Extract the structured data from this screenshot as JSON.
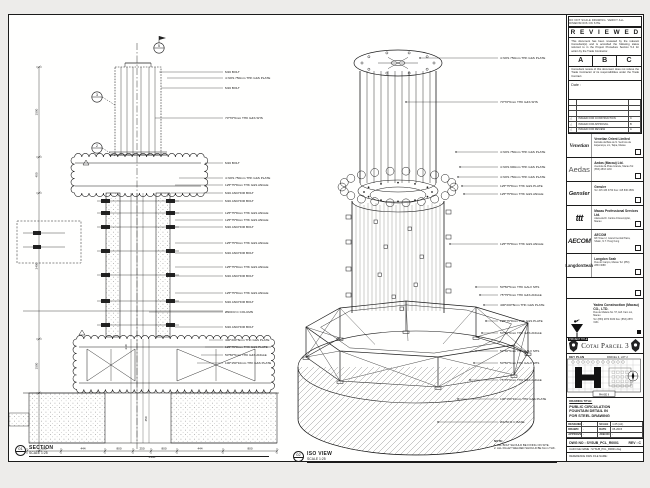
{
  "page": {
    "bg": "#edecea",
    "line": "#1b1b1b"
  },
  "section_view": {
    "marker_id": "01",
    "title": "SECTION",
    "scale": "SCALE 1:25",
    "bubbles": [
      "5",
      "3",
      "2"
    ],
    "labels": [
      "M16 BOLT",
      "4 NOS 750mm THK G&S PLATE",
      "M16 BOLT",
      "70*70*6mm THK G&S SHS",
      "M16 BOLT",
      "4 NOS 750mm THK G&S PLATE",
      "125*75*8mm THK G&S ANGLE",
      "M16 ANCHOR BOLT",
      "M16 ANCHOR BOLT",
      "125*75*8mm THK G&S ANGLE",
      "125*75*8mm THK G&S ANGLE",
      "M16 ANCHOR BOLT",
      "125*75*8mm THK G&S ANGLE",
      "M16 ANCHOR BOLT",
      "125*75*8mm THK G&S ANGLE",
      "M16 ANCHOR BOLT",
      "125*75*8mm THK G&S ANGLE",
      "M16 ANCHOR BOLT",
      "Ø900 R.C COLUMN",
      "M16 ANCHOR BOLT",
      "400*200*8mm THK G&S PLATE",
      "125*75*8mm THK G&S PLATE",
      "50*50*5mm THK G&S ANGLE",
      "100*150*10mm THK G&S PLATE"
    ],
    "dims_bottom": [
      "800",
      "444",
      "800",
      "250",
      "800",
      "444",
      "800"
    ],
    "dims_bottom_total": "4338",
    "dims_left": [
      "1500",
      "400",
      "2400",
      "1500"
    ],
    "dims_mid": [
      "450",
      "240"
    ]
  },
  "iso_view": {
    "marker_id": "02",
    "title": "ISO VIEW",
    "scale": "SCALE 1:25",
    "labels": [
      "4 NOS 750mm THK G&S PLATE",
      "70*70*6mm THK G&S SHS",
      "4 NOS 750mm THK G&S PLATE",
      "4 NOS 900mm THK G&S PLATE",
      "4 NOS 750mm THK G&S PLATE",
      "125*75*8mm THK G&S PLATE",
      "125*75*8mm THK G&S ANGLE",
      "125*75*8mm THK G&S ANGLE",
      "50*50*5mm THK GALV SHS",
      "75*75*6mm THK G&S ANGLE",
      "400*200*8mm THK G&S PLATE",
      "125*75*8mm THK G&S PLATE",
      "50*50*6mm THK G&S ANGLE",
      "50*50*5mm THK GALV SHS",
      "50*50*5mm THK GALV SHS",
      "75*75*6mm THK G&S ANGLE",
      "100*150*10mm THK G&S PLATE",
      "Ø4250 R.C BASE"
    ],
    "note_title": "NOTE:",
    "note_lines": [
      "1. ALL BOLT SHOULD BE FIXING ON SITE.",
      "2. ALL FILLET WELDED SHOULD BE 6mm THK."
    ]
  },
  "title_block": {
    "top_strip": "DO NOT SCALE DRAWING. VERIFY ALL DIMENSIONS ON SITE.",
    "reviewed": {
      "title": "R E V I E W E D",
      "para1": "This document has been reviewed by the relevant Consultant(s) and is accorded the following status referred  to in the Project Procedure Section 5.4 for action by the Trade Contractor.",
      "options": [
        "A",
        "B",
        "C"
      ],
      "para2": "Consultant review of this document does not relieve the Trade Contractor of its responsibilities under the Trade Contract.",
      "date_label": "Date :"
    },
    "revisions": [
      {
        "sym": "△",
        "desc": "ISSUED FOR CONSTRUCTION",
        "rev": "C"
      },
      {
        "sym": "△",
        "desc": "ISSUED FOR APPROVAL",
        "rev": "B"
      },
      {
        "sym": "△",
        "desc": "ISSUED FOR REVIEW",
        "rev": "A"
      }
    ],
    "consultants": [
      {
        "logo": "Venetian",
        "name": "Venetian Orient Limited",
        "addr": "Estrada da Baía de N. Senhora da Esperança, s/n, Taipa, Macau"
      },
      {
        "logo": "Aedas",
        "name": "Aedas (Macau) Ltd.",
        "addr": "Avenida da Praia Grande, Macau  Tel: (853) 2833 1133"
      },
      {
        "logo": "Gensler",
        "name": "Gensler",
        "addr": "Tel: 415 433 3700  Fax: 415 836 4599"
      },
      {
        "logo": "ttt",
        "name": "Macau Professional Services Ltd.",
        "addr": "Alameda Dr. Carlos d'Assumpção, Macau"
      },
      {
        "logo": "AECOM",
        "name": "AECOM",
        "addr": "8/F Tower 2, Grand Central Plaza, Shatin, N.T. Hong Kong"
      },
      {
        "logo": "LangdonSeah",
        "name": "Langdon Seah",
        "addr": "Rua do Campo, Macau  Tel: (853) 2833 3088"
      }
    ],
    "contractor": {
      "name": "Yadea Construction (Macau) CO., LTD.",
      "addr": "Rua de Malaca No. 57, Edf. Kam Loi, Macau",
      "tel": "Tel: (853) 2870 3030  Fax: (853) 2870 3131"
    },
    "project_label": "PROJECT TITLE",
    "project_title": "Cotai Parcel 3",
    "key_plan": {
      "label": "KEY PLAN",
      "lot": "PARCEL 3, LOT 2",
      "tag": "PHASE II"
    },
    "drawing": {
      "label": "DRAWING TITLE:",
      "lines": [
        "PUBLIC CIRCULATION",
        "FOUNTAIN DETAIL IN",
        "FOR STEEL DRAWING"
      ]
    },
    "fields": [
      [
        "DESIGNED",
        "-",
        "SCALE",
        "1:25 (A1)"
      ],
      [
        "DRAWN",
        "-",
        "DATE",
        "05-2015"
      ],
      [
        "APPROVED",
        "-",
        "JOB NO",
        "-"
      ]
    ],
    "dwg": {
      "label": "DWG NO :",
      "no": "SYSUB_PCL_R0001",
      "rev_label": "REV :",
      "rev": "C"
    },
    "cad": "CAD FILE NAME : SYSUB_PCL_R0001.dwg",
    "ref": "REFERENCE DWG FILE NAME :"
  }
}
